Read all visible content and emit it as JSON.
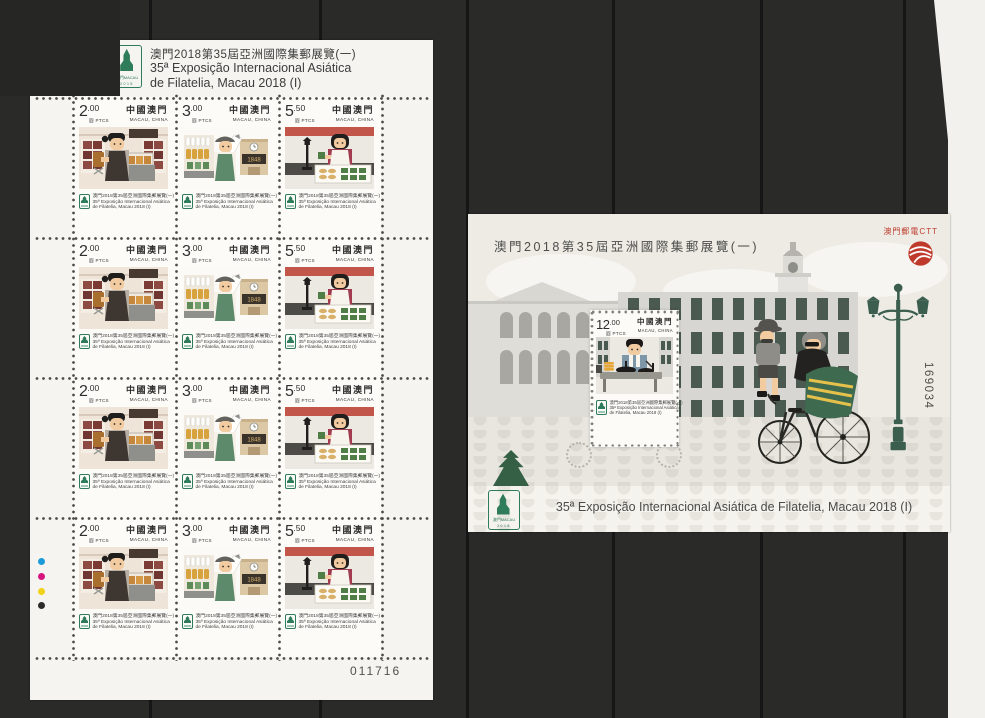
{
  "palette": {
    "background": "#2a2a29",
    "seam": "#161616",
    "sheet_white": "#f5f4f0",
    "stamp_white": "#fcfbf8",
    "logo_green": "#2f7c5b",
    "lamp_green": "#3b5e4e",
    "post_red": "#bf3a2b",
    "registration_cyan": "#1b9cd8",
    "registration_magenta": "#d6167e",
    "registration_yellow": "#f0d219",
    "registration_black": "#2b2b29"
  },
  "left_sheet": {
    "header": {
      "line1": "澳門2018第35屆亞洲國際集郵展覽(一)",
      "line2": "35ª Exposição Internacional Asiática",
      "line3": "de Filatelia, Macau 2018 (I)"
    },
    "logo": {
      "text": "澳門MACAU",
      "year": "2018"
    },
    "caption": {
      "line1": "澳門2018第35屆亞洲國際集郵展覽(一)",
      "line2": "35ª Exposição Internacional Asiática",
      "line3": "de Filatelia, Macau 2018 (I)"
    },
    "stamps": [
      {
        "value": "2",
        "cents": ".00",
        "currency": "圓 PTCS",
        "country_zh": "中國澳門",
        "country_en": "MACAU, CHINA",
        "subject": "dried meat shop keeper"
      },
      {
        "value": "3",
        "cents": ".00",
        "currency": "圓 PTCS",
        "country_zh": "中國澳門",
        "country_en": "MACAU, CHINA",
        "subject": "fishmonger",
        "sign_text": "1848"
      },
      {
        "value": "5",
        "cents": ".50",
        "currency": "圓 PTCS",
        "country_zh": "中國澳門",
        "country_en": "MACAU, CHINA",
        "subject": "pastry shop keeper"
      }
    ],
    "rows": 4,
    "serial_number": "011716"
  },
  "right_sheet": {
    "title": "澳門2018第35屆亞洲國際集郵展覽(一)",
    "post_operator": "澳門郵電CTT",
    "caption": "35ª Exposição Internacional Asiática de Filatelia, Macau 2018 (I)",
    "serial_number": "169034",
    "logo": {
      "text": "澳門MACAU",
      "year": "2018"
    },
    "stamp": {
      "value": "12",
      "cents": ".00",
      "currency": "圓 PTCS",
      "country_zh": "中國澳門",
      "country_en": "MACAU, CHINA",
      "caption1": "澳門2018第35屆亞洲國際集郵展覽(一)",
      "caption2": "35ª Exposição Internacional Asiática",
      "caption3": "de Filatelia, Macau 2018 (I)",
      "subject": "street food cook"
    }
  }
}
